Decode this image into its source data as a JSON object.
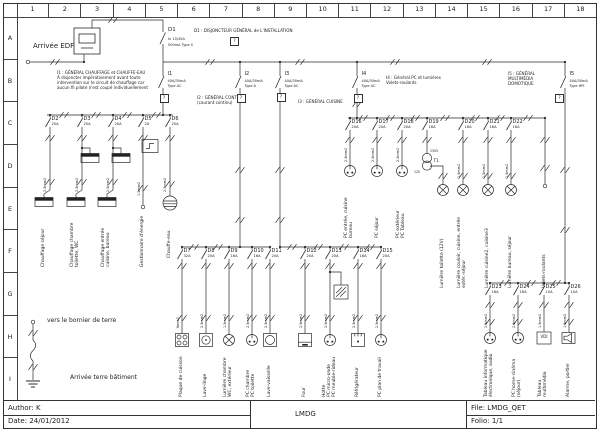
{
  "frame": {
    "cols": [
      "1",
      "2",
      "3",
      "4",
      "5",
      "6",
      "7",
      "8",
      "9",
      "10",
      "11",
      "12",
      "13",
      "14",
      "15",
      "16",
      "17",
      "18"
    ],
    "rows": [
      "A",
      "B",
      "C",
      "D",
      "E",
      "F",
      "G",
      "H",
      "I"
    ]
  },
  "title_block": {
    "author": "Author: K",
    "date": "Date: 24/01/2012",
    "project": "LMDG",
    "file": "File: LMDG_QET",
    "folio": "Folio: 1/1"
  },
  "incoming": {
    "label": "Arrivée EDF"
  },
  "earth": {
    "top": "vers le bornier de terre",
    "bottom": "Arrivée terre bâtiment"
  },
  "main_breaker": {
    "id": "D1",
    "rating": "In 10/45A",
    "diff": "500mA Type S",
    "note": "D1 : DISJONCTEUR GÉNÉRAL de L'INSTALLATION"
  },
  "differentials": [
    {
      "id": "I1",
      "rating": "40A/30mA",
      "type": "Type AC",
      "note": "I1 : GÉNÉRAL CHAUFFAGE et CHAUFFE-EAU\nÀ disjoncter impérativement avant toute\nintervention sur le circuit de chauffage car\naucun fil pilote n'est coupé individuellement"
    },
    {
      "id": "I2",
      "rating": "40A/30mA",
      "type": "Type A",
      "note": "I2 : GÉNÉRAL CONTINU\n(courant continu)"
    },
    {
      "id": "I3",
      "rating": "40A/30mA",
      "type": "Type AC",
      "note": "I3 : GÉNÉRAL CUISINE"
    },
    {
      "id": "I4",
      "rating": "40A/30mA",
      "type": "Type AC",
      "note": "I4 : Général PC et lumières\nVolets-roulants"
    },
    {
      "id": "I5",
      "rating": "40A/30mA",
      "type": "Type HPI",
      "note": "I5 : GÉNÉRAL\nMULTIMÉDIA\nDOMOTIQUE"
    }
  ],
  "circuits": [
    {
      "id": "D2",
      "amp": "20A",
      "wire": "2.5mm2",
      "load": "Chauffage séjour"
    },
    {
      "id": "D3",
      "amp": "20A",
      "wire": "2.5mm2",
      "load": "Chauffage chambre\ntoilette, WC"
    },
    {
      "id": "D4",
      "amp": "20A",
      "wire": "2.5mm2",
      "load": "Chauffage entrée\ncuisine, bureau"
    },
    {
      "id": "D5",
      "amp": "2A",
      "wire": "1.5mm2",
      "load": "Gestionnaire d'énergie"
    },
    {
      "id": "D6",
      "amp": "20A",
      "wire": "2.5mm2",
      "load": "Chauffe-eau"
    },
    {
      "id": "D7",
      "amp": "32A",
      "wire": "6mm2",
      "load": "Plaque de cuisson"
    },
    {
      "id": "D8",
      "amp": "20A",
      "wire": "2.5mm2",
      "load": "Lave-linge"
    },
    {
      "id": "D9",
      "amp": "16A",
      "wire": "1.5mm2",
      "load": "Lumière chambre\nWC, extérieur"
    },
    {
      "id": "D10",
      "amp": "16A",
      "wire": "2.5mm2",
      "load": "PC chambre\nPC toilette"
    },
    {
      "id": "D11",
      "amp": "20A",
      "wire": "2.5mm2",
      "load": "Lave-vaisselle"
    },
    {
      "id": "D12",
      "amp": "20A",
      "wire": "2.5mm2",
      "load": "Four"
    },
    {
      "id": "D13",
      "amp": "20A",
      "wire": "2.5mm2",
      "load": "Hotte\nPC micro-onde\nPC meuble-rideau"
    },
    {
      "id": "D14",
      "amp": "16A",
      "wire": "2.5mm2",
      "load": "Réfrigérateur"
    },
    {
      "id": "D15",
      "amp": "20A",
      "wire": "2.5mm2",
      "load": "PC plan de travail"
    },
    {
      "id": "D16",
      "amp": "20A",
      "wire": "2.5mm2",
      "load": "PC entrée, cuisine\nbureau"
    },
    {
      "id": "D17",
      "amp": "20A",
      "wire": "2.5mm2",
      "load": "PC séjour"
    },
    {
      "id": "D18",
      "amp": "20A",
      "wire": "2.5mm2",
      "load": "PC extérieur\nPC Tableau"
    },
    {
      "id": "D19",
      "amp": "16A",
      "wire": "",
      "load": "Lumière toilette (12V)"
    },
    {
      "id": "D20",
      "amp": "16A",
      "wire": "1.5mm2",
      "load": "Lumière couloir, cuisine, entrée\nextér.-séjour"
    },
    {
      "id": "D21",
      "amp": "16A",
      "wire": "1.5mm2",
      "load": "Lumière cuisine2, cuisine3"
    },
    {
      "id": "D22",
      "amp": "16A",
      "wire": "1.5mm2",
      "load": "Lumière bureau, séjour"
    },
    {
      "id": "D23",
      "amp": "16A",
      "wire": "2.5mm2",
      "load": "Tableau informatique\nélectronique, audio"
    },
    {
      "id": "D24",
      "amp": "16A",
      "wire": "2.5mm2",
      "load": "PC home-cinéma\n(séjour)"
    },
    {
      "id": "D25",
      "amp": "10A",
      "wire": "1.5mm2",
      "load": "Tableau\nmultimédia"
    },
    {
      "id": "D26",
      "amp": "10A",
      "wire": "1.5mm2",
      "load": "Alarme, portier"
    }
  ],
  "extras": {
    "q": "?",
    "volets": "Volets-roulants",
    "t1": "T1",
    "v230": "230V",
    "v12": "12V",
    "vdi": "VDI"
  }
}
